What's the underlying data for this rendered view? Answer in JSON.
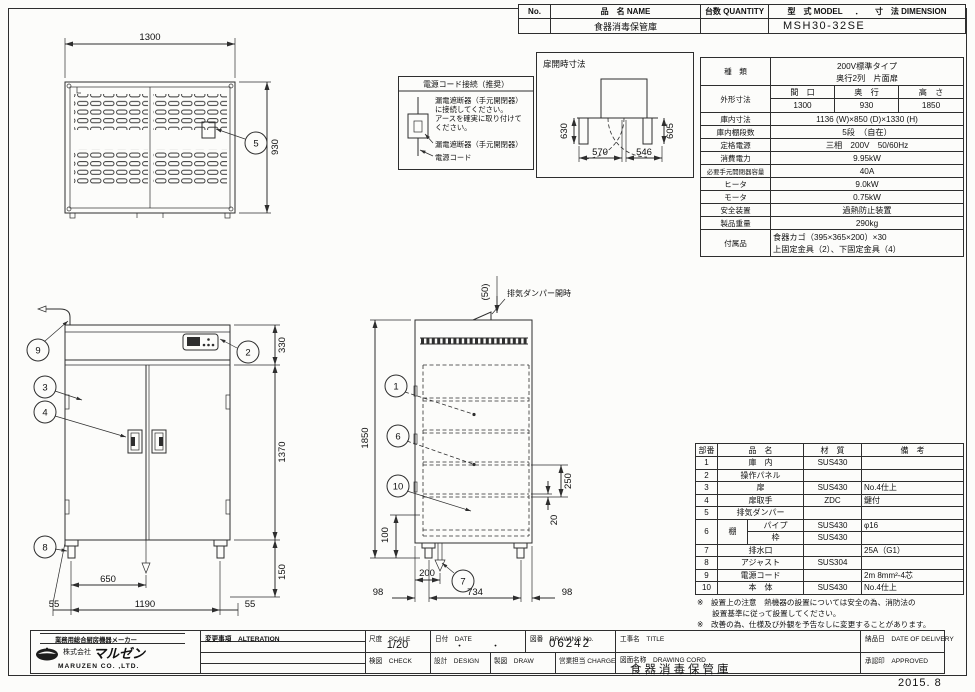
{
  "header_table": {
    "no_label": "No.",
    "name_label": "品　名 NAME",
    "qty_label": "台数 QUANTITY",
    "model_label": "型　式 MODEL",
    "dot": "．",
    "dim_label": "寸　法 DIMENSION",
    "name_value": "食器消毒保管庫",
    "model_value": "MSH30-32SE"
  },
  "power_box": {
    "title": "電源コード接続（推奨）",
    "line1": "漏電遮断器（手元開閉器）",
    "line2": "に接続してください。",
    "line3": "アースを確実に取り付けて",
    "line4": "ください。",
    "breaker_label": "漏電遮断器（手元開閉器）",
    "cord_label": "電源コード"
  },
  "door_open_view": {
    "title": "扉開時寸法",
    "dim_left": "630",
    "dim_right": "605",
    "dim_bottom_left": "570",
    "dim_bottom_right": "546"
  },
  "plan_view": {
    "dim_width": "1300",
    "dim_depth": "930",
    "callout_damper": "5"
  },
  "front_view": {
    "dim_top_section": "330",
    "dim_door_height": "1370",
    "dim_foot_height": "150",
    "dim_drain_x": "650",
    "dim_feet_span": "1190",
    "dim_side_left": "55",
    "dim_side_right": "55",
    "callout_cord": "9",
    "callout_panel": "2",
    "callout_door": "3",
    "callout_handle": "4",
    "callout_foot": "8"
  },
  "side_view": {
    "dim_height": "1850",
    "dim_damper_open": "(50)",
    "damper_label": "排気ダンパー開時",
    "dim_shelf_pitch": "250",
    "dim_shelf_gap": "20",
    "dim_bottom": "100",
    "dim_drain_offset": "200",
    "dim_front": "98",
    "dim_span": "734",
    "dim_rear": "98",
    "callout_basket": "1",
    "callout_shelf": "6",
    "callout_body": "10",
    "callout_drain": "7"
  },
  "spec_table": {
    "kind_label": "種　類",
    "kind_value1": "200V標準タイプ",
    "kind_value2": "奥行2列　片面扉",
    "outer_label": "外形寸法",
    "outer_w_label": "間　口",
    "outer_d_label": "奥　行",
    "outer_h_label": "高　さ",
    "outer_w": "1300",
    "outer_d": "930",
    "outer_h": "1850",
    "inner_label": "庫内寸法",
    "inner_value": "1136 (W)×850 (D)×1330 (H)",
    "shelves_label": "庫内棚段数",
    "shelves_value": "5段　（自在）",
    "power_label": "定格電源",
    "power_value": "三相　200V　50/60Hz",
    "consumption_label": "消費電力",
    "consumption_value": "9.95kW",
    "breaker_label": "必要手元開閉器容量",
    "breaker_value": "40A",
    "heater_label": "ヒータ",
    "heater_value": "9.0kW",
    "motor_label": "モータ",
    "motor_value": "0.75kW",
    "safety_label": "安全装置",
    "safety_value": "過熱防止装置",
    "weight_label": "製品重量",
    "weight_value": "290kg",
    "accessory_label": "付属品",
    "accessory_value1": "食器カゴ（395×365×200）×30",
    "accessory_value2": "上固定金具（2）、下固定金具（4）"
  },
  "parts_table": {
    "h_no": "部番",
    "h_name": "品　名",
    "h_material": "材　質",
    "h_note": "備　考",
    "rows": [
      {
        "no": "1",
        "name": "庫　内",
        "material": "SUS430",
        "note": ""
      },
      {
        "no": "2",
        "name": "操作パネル",
        "material": "",
        "note": ""
      },
      {
        "no": "3",
        "name": "扉",
        "material": "SUS430",
        "note": "No.4仕上"
      },
      {
        "no": "4",
        "name": "扉取手",
        "material": "ZDC",
        "note": "鍵付"
      },
      {
        "no": "5",
        "name": "排気ダンパー",
        "material": "",
        "note": ""
      },
      {
        "no": "6",
        "name": "棚",
        "subs": [
          {
            "name": "パイプ",
            "material": "SUS430",
            "note": "φ16"
          },
          {
            "name": "枠",
            "material": "SUS430",
            "note": ""
          }
        ]
      },
      {
        "no": "7",
        "name": "排水口",
        "material": "",
        "note": "25A（G1）"
      },
      {
        "no": "8",
        "name": "アジャスト",
        "material": "SUS304",
        "note": ""
      },
      {
        "no": "9",
        "name": "電源コード",
        "material": "",
        "note": "2m 8mm²-4芯"
      },
      {
        "no": "10",
        "name": "本　体",
        "material": "SUS430",
        "note": "No.4仕上"
      }
    ]
  },
  "notes": {
    "note1_line1": "※　設置上の注意　熱機器の設置については安全の為、消防法の",
    "note1_line2": "　　設置基準に従って設置してください。",
    "note2": "※　改善の為、仕様及び外観を予告なしに変更することがあります。"
  },
  "title_block": {
    "maker_tagline": "業務用総合厨房機器メーカー",
    "company_prefix": "株式会社",
    "company_name": "マルゼン",
    "company_en": "MARUZEN  CO. ,LTD.",
    "alteration_label": "変更事項　ALTERATION",
    "scale_label": "尺度　SCALE",
    "scale_value": "1/20",
    "date_label": "日付　DATE",
    "date_value": "・　　　・",
    "drawing_no_label": "図番　DRAWING No.",
    "drawing_no_value": "06242",
    "check_label": "検図　CHECK",
    "design_label": "設計　DESIGN",
    "draw_label": "製図　DRAW",
    "charge_label": "営業担当 CHARGE",
    "title_label": "工事名　TITLE",
    "drawing_name_label": "図面名称　DRAWING CORD",
    "drawing_name_value": "食器消毒保管庫",
    "delivery_label": "納品日　DATE OF DELIVERY",
    "approved_label": "承認印　APPROVED",
    "issue_date": "2015. 8"
  }
}
